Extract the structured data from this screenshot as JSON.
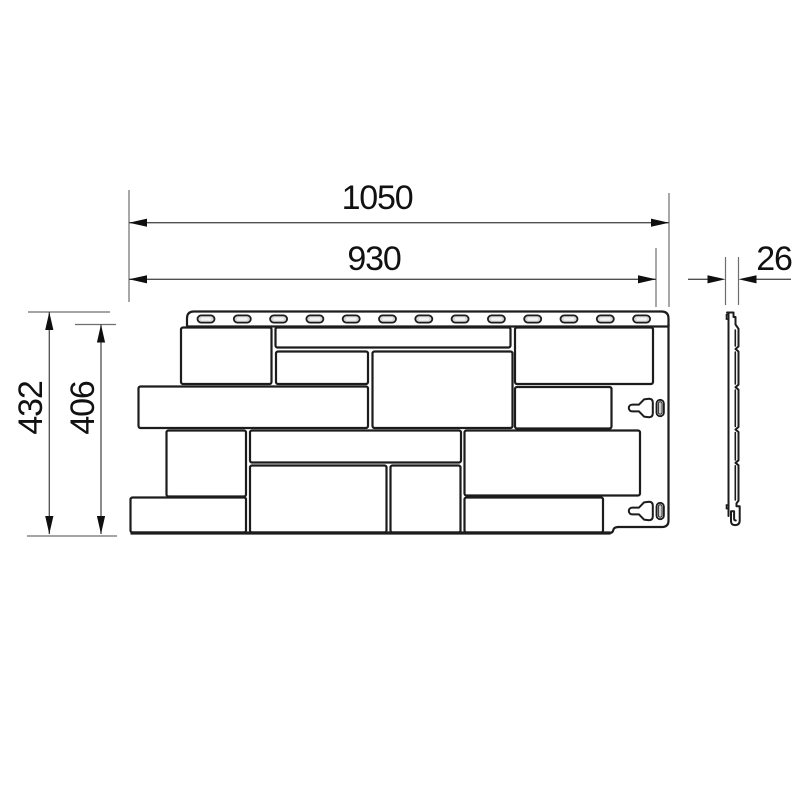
{
  "drawing": {
    "background": "#ffffff",
    "outline_color": "#1c1c1c",
    "dim_line_color": "#4f4f4f",
    "ext_line_color": "#6e6e6e",
    "arrow_color": "#0f0f0f",
    "text_color": "#111111",
    "dimensions": {
      "overall_width": "1050",
      "visible_width": "930",
      "thickness": "26",
      "overall_height": "432",
      "visible_height": "406"
    },
    "front_view": {
      "nail_slot_count": 13,
      "stone_count": 14,
      "lock_hook_count": 2
    }
  }
}
